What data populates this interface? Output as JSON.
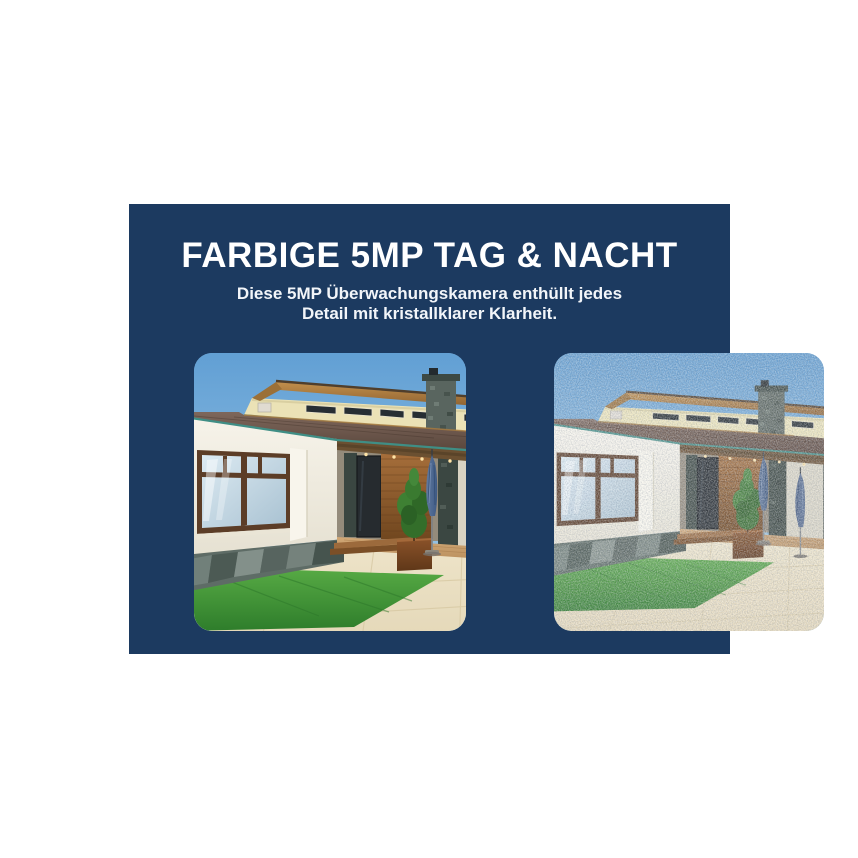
{
  "banner": {
    "background_color": "#1C3A60",
    "text_color": "#FFFFFF",
    "title": "FARBIGE 5MP TAG & NACHT",
    "subtitle_line1": "Diese 5MP Überwachungskamera enthüllt jedes",
    "subtitle_line2": "Detail mit kristallklarer Klarheit."
  },
  "comparison": {
    "left_label": "Argus 3 Pro-5MP",
    "right_label": "Andere-2K"
  }
}
